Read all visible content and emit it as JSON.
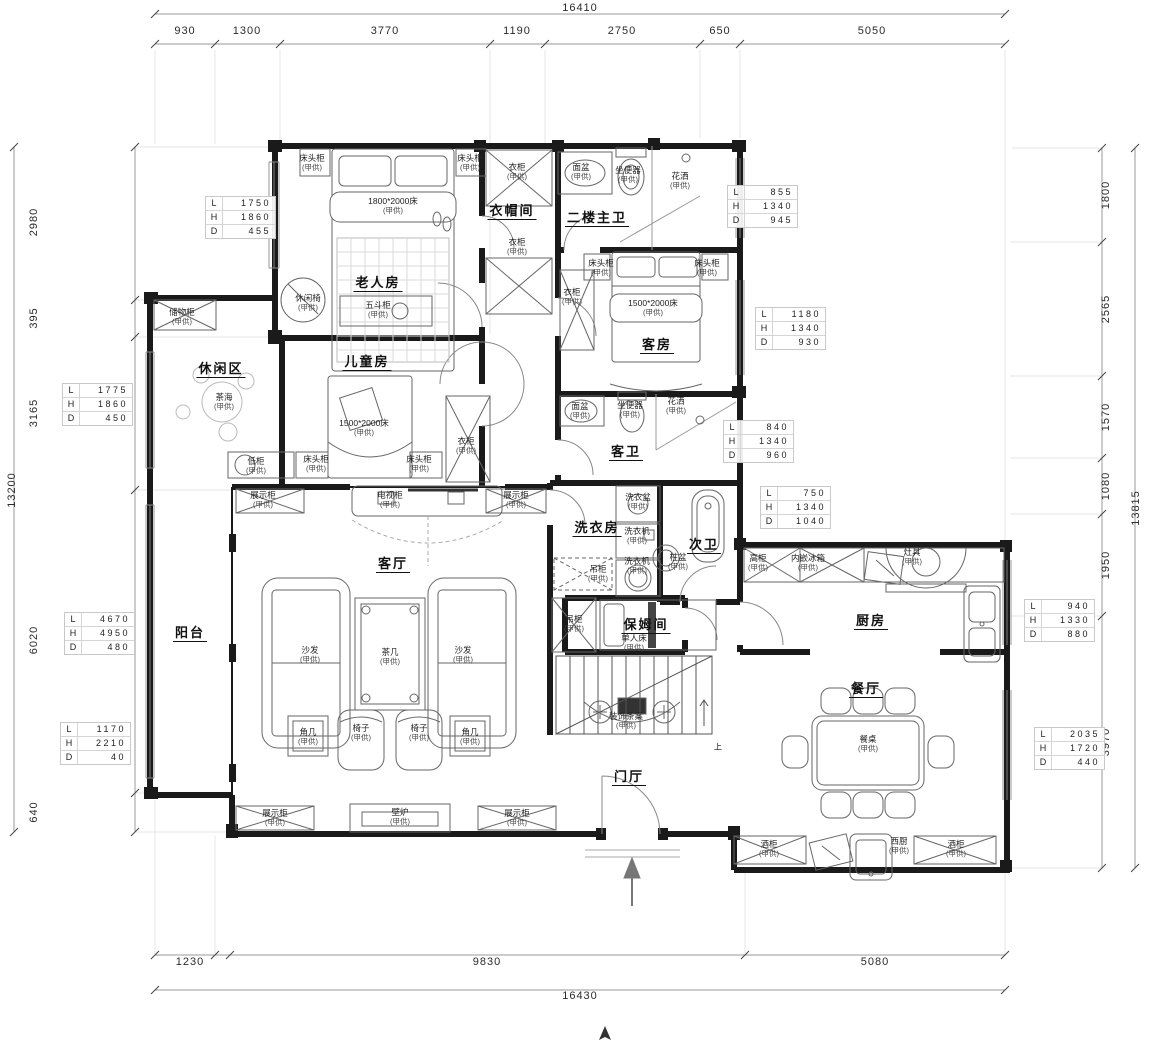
{
  "plan": {
    "rooms": {
      "elder": "老人房",
      "cloak": "衣帽间",
      "master_bath": "二楼主卫",
      "guest": "客房",
      "kids": "儿童房",
      "leisure": "休闲区",
      "guest_bath": "客卫",
      "laundry": "洗衣房",
      "second_bath": "次卫",
      "living": "客厅",
      "balcony": "阳台",
      "nanny": "保姆间",
      "kitchen": "厨房",
      "dining": "餐厅",
      "foyer": "门厅",
      "stair_up": "上"
    },
    "furn": {
      "supply": "(甲供)",
      "bedside": "床头柜",
      "bed1800": "1800*2000床",
      "bed1500": "1500*2000床",
      "wardrobe": "衣柜",
      "lounge_chair": "休闲椅",
      "dresser": "五斗柜",
      "storage_cab": "储物柜",
      "tea_table": "茶海",
      "low_cab": "低柜",
      "basin": "面盆",
      "toilet": "坐便器",
      "shower": "花洒",
      "wash_basin": "洗衣盆",
      "washer": "洗衣机",
      "hanging_cab": "吊柜",
      "pedestal_basin": "柱盆",
      "tall_cab": "高柜",
      "fridge": "内嵌冰箱",
      "stove": "灶具",
      "display_cab": "展示柜",
      "tv_cab": "电视柜",
      "sofa": "沙发",
      "coffee_table": "茶几",
      "corner_table": "角几",
      "chair": "椅子",
      "fireplace": "壁炉",
      "single_bed": "单人床",
      "console": "装饰条案",
      "dining_table": "餐桌",
      "wine_cab": "酒柜",
      "west_kitchen": "西厨"
    }
  },
  "dims": {
    "top_total": "16410",
    "top": [
      "930",
      "1300",
      "3770",
      "1190",
      "2750",
      "650",
      "5050"
    ],
    "left_total": "13200",
    "left": [
      "2980",
      "395",
      "3165",
      "6020",
      "640"
    ],
    "right_total": "13815",
    "right": [
      "1800",
      "2565",
      "1570",
      "1080",
      "1950",
      "3970"
    ],
    "bottom": [
      "1230",
      "9830",
      "5080"
    ],
    "bottom_total": "16430"
  },
  "callouts": {
    "keys": {
      "l": "L",
      "h": "H",
      "d": "D"
    },
    "c1": {
      "l": "1750",
      "h": "1860",
      "d": "455"
    },
    "c2": {
      "l": "855",
      "h": "1340",
      "d": "945"
    },
    "c3": {
      "l": "1180",
      "h": "1340",
      "d": "930"
    },
    "c4": {
      "l": "1775",
      "h": "1860",
      "d": "450"
    },
    "c5": {
      "l": "840",
      "h": "1340",
      "d": "960"
    },
    "c6": {
      "l": "750",
      "h": "1340",
      "d": "1040"
    },
    "c7": {
      "l": "4670",
      "h": "4950",
      "d": "480"
    },
    "c8": {
      "l": "1170",
      "h": "2210",
      "d": "40"
    },
    "c9": {
      "l": "940",
      "h": "1330",
      "d": "880"
    },
    "c10": {
      "l": "2035",
      "h": "1720",
      "d": "440"
    }
  }
}
